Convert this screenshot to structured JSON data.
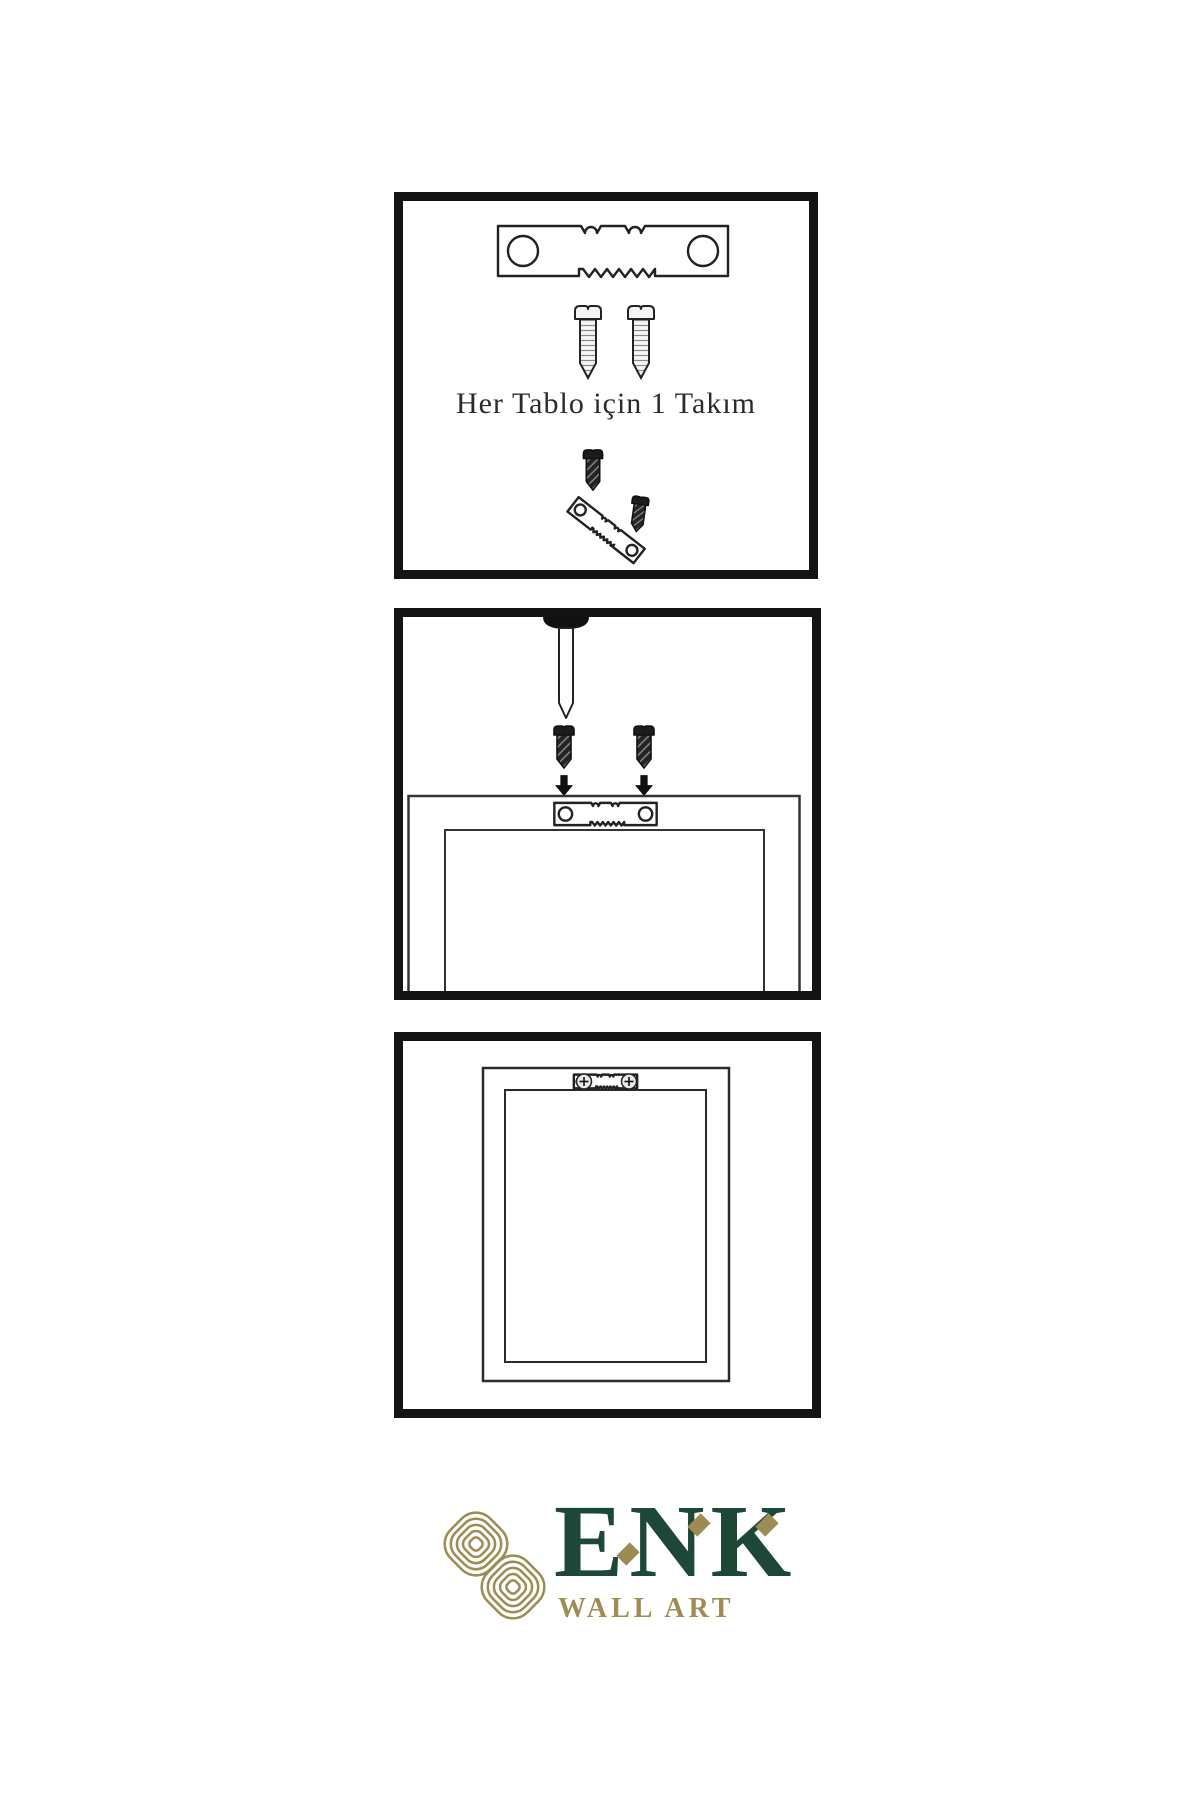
{
  "canvas": {
    "width": 1200,
    "height": 1800,
    "background": "#ffffff"
  },
  "colors": {
    "panel_border": "#141414",
    "line_art": "#222222",
    "hardware_dark": "#1c1c1c",
    "brand_green": "#1d4736",
    "brand_gold": "#9c8b52",
    "subtitle_gold": "#a08d55"
  },
  "steps": [
    {
      "id": "hardware-set",
      "caption": "Her Tablo için 1 Takım",
      "icons": [
        "sawtooth-hanger-icon",
        "mounting-screw-icon",
        "mounting-screw-icon",
        "dark-screw-icon",
        "tilted-sawtooth-hanger-icon",
        "dark-screw-icon"
      ]
    },
    {
      "id": "attach-hanger",
      "icons": [
        "wall-nail-icon",
        "dark-screw-icon",
        "dark-screw-icon",
        "down-arrow-icon",
        "down-arrow-icon",
        "frame-back-icon",
        "sawtooth-hanger-icon"
      ]
    },
    {
      "id": "hang-frame",
      "icons": [
        "framed-picture-icon",
        "mounted-sawtooth-hanger-icon",
        "screw-head-icon",
        "screw-head-icon"
      ]
    }
  ],
  "brand": {
    "name": "ENK",
    "subtitle": "WALL ART",
    "emblem": "interlaced-knot-icon"
  }
}
